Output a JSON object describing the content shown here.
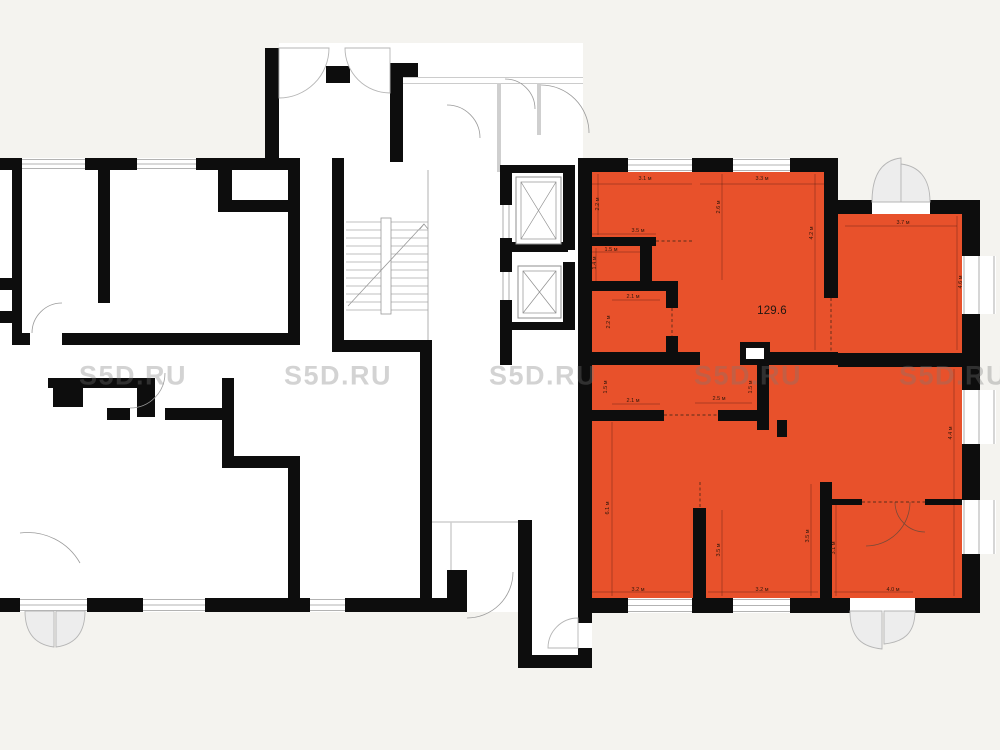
{
  "unit": {
    "area_label": "129.6",
    "color": "#e8512b"
  },
  "watermark": {
    "text": "S5D.RU",
    "y": 376,
    "x_centers": [
      133,
      338,
      543,
      748,
      953
    ]
  },
  "colors": {
    "background": "#f4f3ef",
    "wall": "#0d0d0d",
    "room": "#ffffff",
    "door_fill": "#ededed",
    "door_stroke": "#b5b5b5",
    "dim_text": "#2e170b"
  },
  "dimensions": [
    {
      "t": "3.1 м",
      "x": 645,
      "y": 179,
      "r": 0
    },
    {
      "t": "3.3 м",
      "x": 762,
      "y": 179,
      "r": 0
    },
    {
      "t": "3.5 м",
      "x": 638,
      "y": 231,
      "r": 0
    },
    {
      "t": "1.5 м",
      "x": 611,
      "y": 250,
      "r": 0
    },
    {
      "t": "3.7 м",
      "x": 903,
      "y": 223,
      "r": 0
    },
    {
      "t": "2.1 м",
      "x": 633,
      "y": 297,
      "r": 0
    },
    {
      "t": "2.1 м",
      "x": 633,
      "y": 401,
      "r": 0
    },
    {
      "t": "2.5 м",
      "x": 719,
      "y": 399,
      "r": 0
    },
    {
      "t": "3.2 м",
      "x": 638,
      "y": 590,
      "r": 0
    },
    {
      "t": "3.2 м",
      "x": 762,
      "y": 590,
      "r": 0
    },
    {
      "t": "4.0 м",
      "x": 893,
      "y": 590,
      "r": 0
    },
    {
      "t": "2.2 м",
      "x": 598,
      "y": 204,
      "r": -90
    },
    {
      "t": "1.4 м",
      "x": 595,
      "y": 263,
      "r": -90
    },
    {
      "t": "2.6 м",
      "x": 719,
      "y": 207,
      "r": -90
    },
    {
      "t": "4.2 м",
      "x": 812,
      "y": 233,
      "r": -90
    },
    {
      "t": "4.6 м",
      "x": 961,
      "y": 282,
      "r": -90
    },
    {
      "t": "2.2 м",
      "x": 609,
      "y": 322,
      "r": -90
    },
    {
      "t": "1.5 м",
      "x": 606,
      "y": 387,
      "r": -90
    },
    {
      "t": "1.5 м",
      "x": 751,
      "y": 387,
      "r": -90
    },
    {
      "t": "6.1 м",
      "x": 608,
      "y": 508,
      "r": -90
    },
    {
      "t": "3.5 м",
      "x": 719,
      "y": 550,
      "r": -90
    },
    {
      "t": "3.5 м",
      "x": 808,
      "y": 536,
      "r": -90
    },
    {
      "t": "3.1 м",
      "x": 834,
      "y": 548,
      "r": -90
    },
    {
      "t": "4.4 м",
      "x": 951,
      "y": 433,
      "r": -90
    }
  ]
}
